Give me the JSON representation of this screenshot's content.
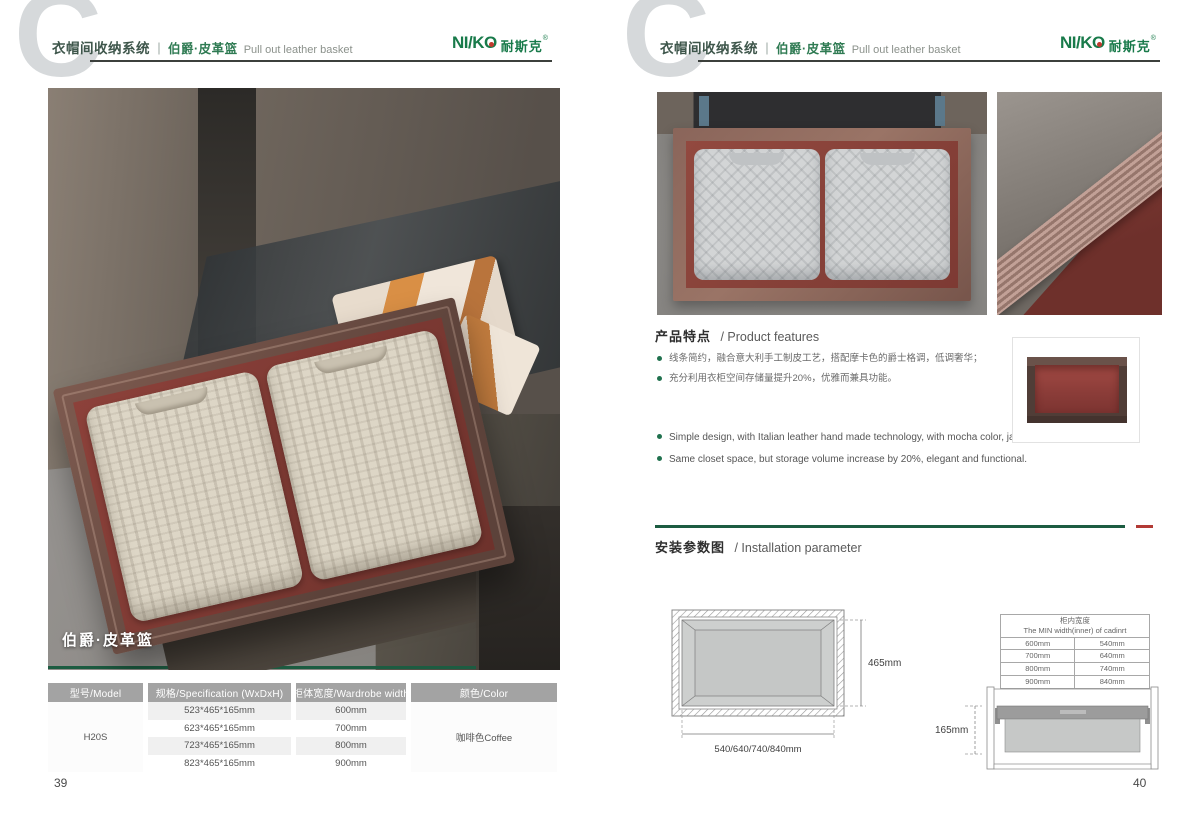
{
  "brand": {
    "logo_latin": "NI/K",
    "logo_o": "O",
    "logo_cn": "耐斯克",
    "reg_mark": "®",
    "green": "#187a4a",
    "accent_red": "#b23a35",
    "accent_green": "#1c5c41"
  },
  "header": {
    "system_title": "衣帽间收纳系统",
    "separator": "｜",
    "product_cn": "伯爵·皮革篮",
    "product_en": "Pull out leather basket"
  },
  "left_page": {
    "photo_caption": "伯爵·皮革篮",
    "page_number": "39",
    "spec_table": {
      "headers": [
        "型号/Model",
        "规格/Specification (WxDxH)",
        "柜体宽度/Wardrobe width",
        "颜色/Color"
      ],
      "model": "H20S",
      "rows": [
        {
          "spec": "523*465*165mm",
          "width": "600mm"
        },
        {
          "spec": "623*465*165mm",
          "width": "700mm"
        },
        {
          "spec": "723*465*165mm",
          "width": "800mm"
        },
        {
          "spec": "823*465*165mm",
          "width": "900mm"
        }
      ],
      "color": "咖啡色Coffee"
    }
  },
  "right_page": {
    "page_number": "40",
    "features": {
      "title_cn": "产品特点",
      "title_en": "/ Product features",
      "bullets_cn": [
        "线条简约，融合意大利手工制皮工艺，搭配摩卡色的爵士格调，低调奢华；",
        "充分利用衣柜空间存储量提升20%，优雅而兼具功能。"
      ],
      "bullets_en": [
        "Simple design, with Italian leather hand made technology, with mocha color, jazz  luxury;",
        "Same closet space,  but storage volume increase by 20%, elegant and functional."
      ]
    },
    "installation": {
      "title_cn": "安装参数图",
      "title_en": "/ Installation parameter",
      "top_view": {
        "depth_label": "465mm",
        "width_label": "540/640/740/840mm"
      },
      "min_width_table": {
        "title_cn": "柜内宽度",
        "title_en": "The MIN width(inner) of cadinrt",
        "rows": [
          [
            "600mm",
            "540mm"
          ],
          [
            "700mm",
            "640mm"
          ],
          [
            "800mm",
            "740mm"
          ],
          [
            "900mm",
            "840mm"
          ]
        ]
      },
      "side_view": {
        "height_label": "165mm"
      }
    }
  }
}
